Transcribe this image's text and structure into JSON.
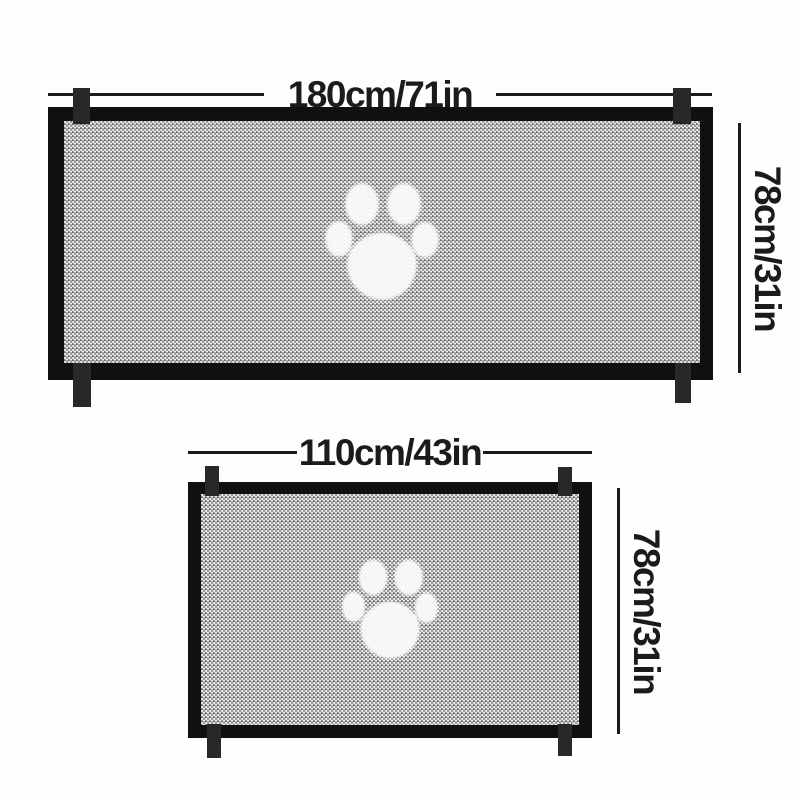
{
  "gates": [
    {
      "name": "large",
      "width_label": "180cm/71in",
      "height_label": "78cm/31in"
    },
    {
      "name": "small",
      "width_label": "110cm/43in",
      "height_label": "78cm/31in"
    }
  ],
  "icons": {
    "paw_icon": "paw-print-icon"
  },
  "colors": {
    "background": "#fffefc",
    "frame": "#101010",
    "tab": "#282828",
    "dimension_line": "#1b1b1b",
    "label_text": "#1b1b1b",
    "mesh_light": "#f2f2f2",
    "mesh_dark": "#9a9a9a",
    "paw": "#fcfcfc"
  }
}
